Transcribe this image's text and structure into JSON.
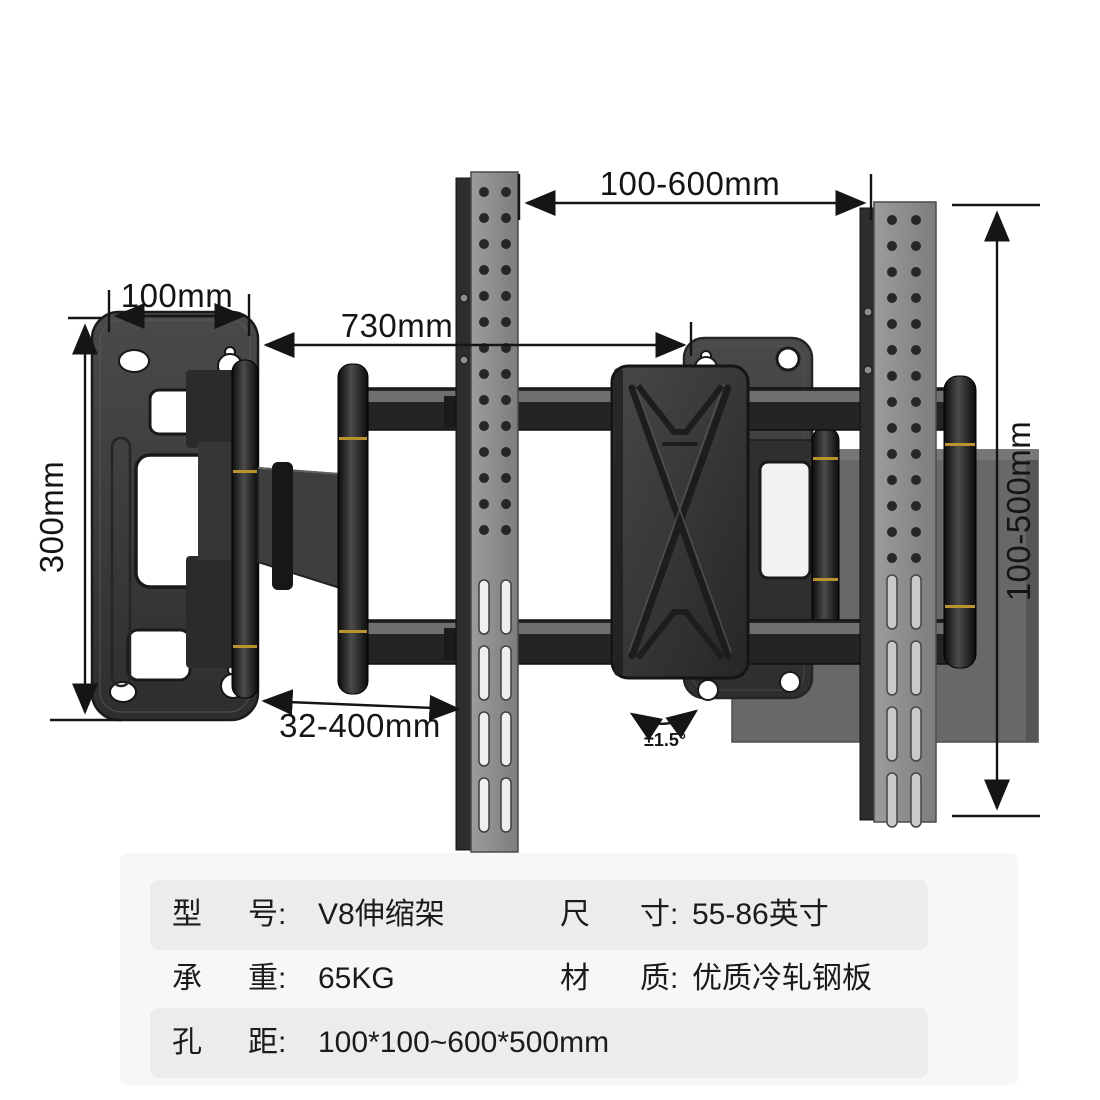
{
  "product": {
    "kind": "tv-wall-mount-dimension-diagram"
  },
  "annotations": {
    "top_span": "100-600mm",
    "plate_width": "100mm",
    "arm_reach": "730mm",
    "plate_height": "300mm",
    "vesa_height": "100-500mm",
    "extension_range": "32-400mm",
    "tilt_angle": "±1.5°"
  },
  "spec_table": {
    "rows": [
      {
        "k1": "型",
        "k2": "号:",
        "v1": "V8伸缩架",
        "k3": "尺",
        "k4": "寸:",
        "v2": "55-86英寸"
      },
      {
        "k1": "承",
        "k2": "重:",
        "v1": "65KG",
        "k3": "材",
        "k4": "质:",
        "v2": "优质冷轧钢板"
      },
      {
        "k1": "孔",
        "k2": "距:",
        "v1": "100*100~600*500mm"
      }
    ]
  },
  "colors": {
    "annotation_ink": "#151515",
    "panel_bg": "#f7f7f7",
    "row_bg": "#ececec",
    "metal_dark": "#242424",
    "rail_gray": "#8e8e8e",
    "gold_accent": "#b9932e"
  }
}
